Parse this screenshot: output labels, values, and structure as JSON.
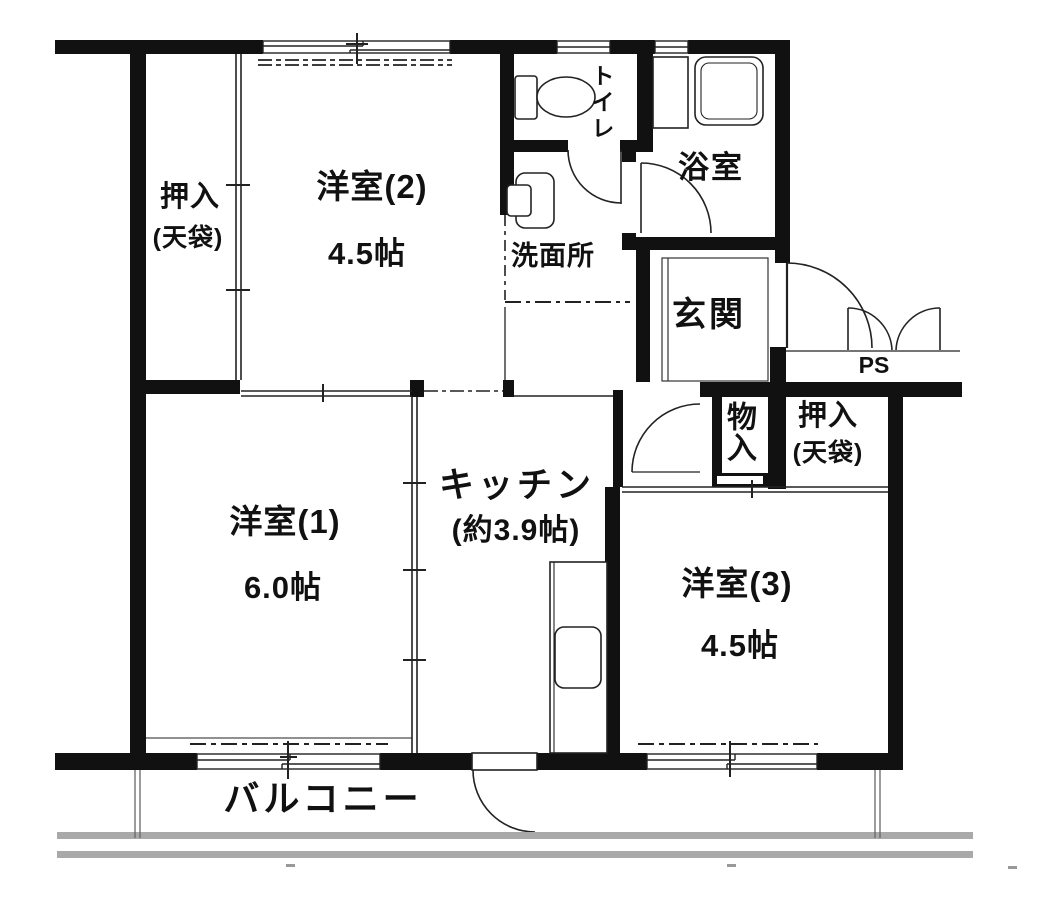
{
  "floorplan": {
    "rooms": {
      "western2": {
        "label": "洋室(2)",
        "size": "4.5帖"
      },
      "western1": {
        "label": "洋室(1)",
        "size": "6.0帖"
      },
      "western3": {
        "label": "洋室(3)",
        "size": "4.5帖"
      },
      "kitchen": {
        "label": "キッチン",
        "size": "(約3.9帖)"
      },
      "closet_nw": {
        "label": "押入",
        "note": "(天袋)"
      },
      "closet_east": {
        "label": "押入",
        "note": "(天袋)"
      },
      "storage": {
        "label": "物入"
      },
      "toilet": {
        "label": "トイレ"
      },
      "bath": {
        "label": "浴室"
      },
      "washroom": {
        "label": "洗面所"
      },
      "entrance": {
        "label": "玄関"
      },
      "pipe_shaft": {
        "label": "PS"
      },
      "balcony": {
        "label": "バルコニー"
      }
    },
    "colors": {
      "wall": "#111111",
      "line": "#222222",
      "rail": "#a9a9a9",
      "background": "#ffffff"
    }
  }
}
